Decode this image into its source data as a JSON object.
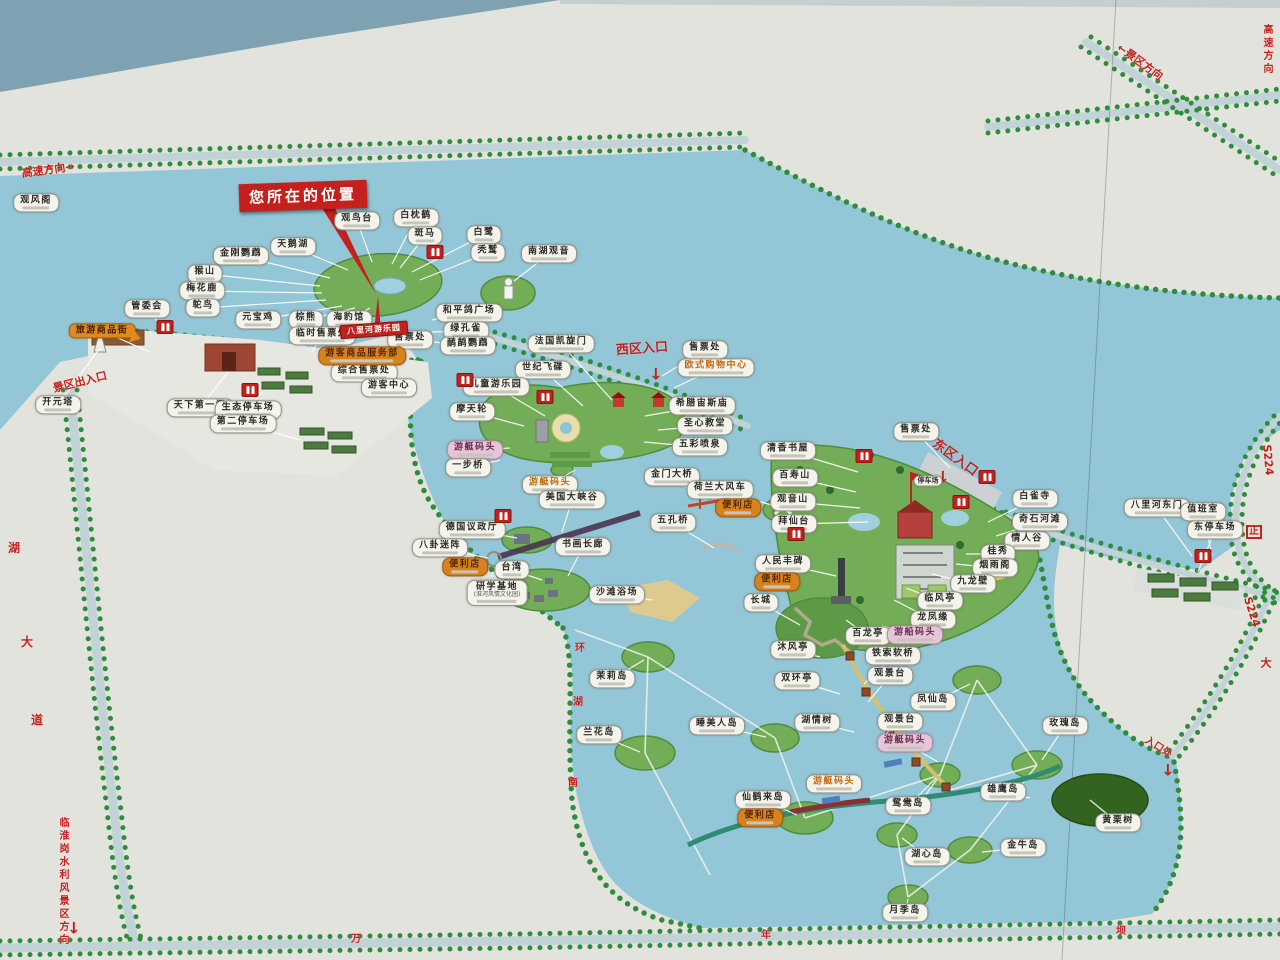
{
  "map": {
    "you_are_here": {
      "label": "您所在的位置",
      "x": 303,
      "y": 196
    },
    "colors": {
      "water": "#93c6d6",
      "board": "#e2e3dc",
      "tree_green": "#2f8c3c",
      "road": "#c2d3d8",
      "sign_red": "#c4201d",
      "label_bg": "#f4f3ec",
      "orange_label": "#d8821f",
      "pink_label": "#e5c6d8",
      "island_green": "#74ad57"
    },
    "road_signs": [
      {
        "t": "高速方向→",
        "x": 48,
        "y": 170,
        "rot": -8,
        "size": 11
      },
      {
        "t": "←景区方向",
        "x": 1140,
        "y": 62,
        "rot": 36,
        "size": 11
      },
      {
        "t": "高速方向",
        "x": 1266,
        "y": 50,
        "vert": true,
        "size": 10
      },
      {
        "t": "S224",
        "x": 1268,
        "y": 460,
        "rot": 85,
        "size": 11
      },
      {
        "t": "正",
        "x": 1254,
        "y": 532,
        "boxed": true,
        "size": 10
      },
      {
        "t": "S224",
        "x": 1252,
        "y": 612,
        "rot": 72,
        "size": 11
      },
      {
        "t": "入口处",
        "x": 1158,
        "y": 748,
        "rot": 32,
        "size": 10
      },
      {
        "t": "西区入口",
        "x": 642,
        "y": 349,
        "rot": -4,
        "size": 13
      },
      {
        "t": "东区入口",
        "x": 955,
        "y": 458,
        "rot": 36,
        "size": 13
      },
      {
        "t": "景区出入口",
        "x": 80,
        "y": 382,
        "rot": -14,
        "size": 11
      },
      {
        "t": "临淮岗水利风景区方向",
        "x": 62,
        "y": 882,
        "vert": true,
        "size": 10
      },
      {
        "t": "湖",
        "x": 14,
        "y": 548,
        "size": 12
      },
      {
        "t": "大",
        "x": 27,
        "y": 642,
        "size": 12
      },
      {
        "t": "道",
        "x": 37,
        "y": 720,
        "size": 12
      },
      {
        "t": "环",
        "x": 580,
        "y": 649,
        "size": 10
      },
      {
        "t": "湖",
        "x": 578,
        "y": 703,
        "size": 10
      },
      {
        "t": "南",
        "x": 573,
        "y": 784,
        "size": 10
      },
      {
        "t": "万",
        "x": 356,
        "y": 940,
        "size": 10
      },
      {
        "t": "年",
        "x": 766,
        "y": 936,
        "size": 10
      },
      {
        "t": "坝",
        "x": 1121,
        "y": 932,
        "size": 10
      },
      {
        "t": "大",
        "x": 1266,
        "y": 663,
        "size": 11
      }
    ],
    "arrows": [
      {
        "x": 656,
        "y": 374
      },
      {
        "x": 943,
        "y": 477
      },
      {
        "x": 1168,
        "y": 770
      },
      {
        "x": 74,
        "y": 928
      }
    ],
    "toilets": [
      {
        "x": 435,
        "y": 252
      },
      {
        "x": 465,
        "y": 380
      },
      {
        "x": 545,
        "y": 397
      },
      {
        "x": 864,
        "y": 456
      },
      {
        "x": 987,
        "y": 477
      },
      {
        "x": 961,
        "y": 502
      },
      {
        "x": 1203,
        "y": 556
      },
      {
        "x": 165,
        "y": 327
      },
      {
        "x": 250,
        "y": 390
      },
      {
        "x": 503,
        "y": 516
      },
      {
        "x": 796,
        "y": 534
      }
    ],
    "poi_labels": [
      {
        "t": "观风阁",
        "x": 36,
        "y": 203
      },
      {
        "t": "观鸟台",
        "x": 357,
        "y": 221,
        "lt": [
          372,
          262
        ]
      },
      {
        "t": "白枕鹤",
        "x": 416,
        "y": 218,
        "lt": [
          392,
          264
        ]
      },
      {
        "t": "斑马",
        "x": 425,
        "y": 236,
        "lt": [
          400,
          268
        ]
      },
      {
        "t": "白鹭",
        "x": 484,
        "y": 235,
        "lt": [
          412,
          272
        ]
      },
      {
        "t": "秃鹫",
        "x": 488,
        "y": 253,
        "lt": [
          420,
          280
        ]
      },
      {
        "t": "南湖观音",
        "x": 549,
        "y": 254,
        "lt": [
          514,
          281
        ]
      },
      {
        "t": "天鹅湖",
        "x": 293,
        "y": 247,
        "lt": [
          348,
          270
        ]
      },
      {
        "t": "金刚鹦鹉",
        "x": 241,
        "y": 256,
        "lt": [
          330,
          278
        ]
      },
      {
        "t": "猴山",
        "x": 205,
        "y": 274,
        "lt": [
          320,
          286
        ]
      },
      {
        "t": "梅花鹿",
        "x": 202,
        "y": 291,
        "lt": [
          322,
          293
        ]
      },
      {
        "t": "鸵鸟",
        "x": 203,
        "y": 308,
        "lt": [
          326,
          300
        ]
      },
      {
        "t": "管委会",
        "x": 147,
        "y": 309,
        "lt": [
          170,
          336
        ]
      },
      {
        "t": "元宝鸡",
        "x": 258,
        "y": 320,
        "lt": [
          342,
          306
        ]
      },
      {
        "t": "棕熊",
        "x": 306,
        "y": 320,
        "lt": [
          355,
          308
        ]
      },
      {
        "t": "海豹馆",
        "x": 349,
        "y": 320,
        "lt": [
          370,
          308
        ]
      },
      {
        "t": "和平鸽广场",
        "x": 469,
        "y": 313,
        "lt": [
          432,
          320
        ]
      },
      {
        "t": "绿孔雀",
        "x": 466,
        "y": 331,
        "lt": [
          432,
          332
        ]
      },
      {
        "t": "鸸鹋鹦鹉",
        "x": 468,
        "y": 346,
        "lt": [
          434,
          342
        ]
      },
      {
        "t": "售票处",
        "x": 410,
        "y": 340,
        "lt": [
          396,
          352
        ]
      },
      {
        "t": "临时售票处",
        "x": 322,
        "y": 336,
        "lt": [
          312,
          352
        ]
      },
      {
        "t": "综合售票处",
        "x": 364,
        "y": 373
      },
      {
        "t": "游客中心",
        "x": 389,
        "y": 388
      },
      {
        "t": "旅游商品街",
        "x": 102,
        "y": 331,
        "s": "balloon",
        "lt": [
          150,
          352
        ]
      },
      {
        "t": "游客商品服务部",
        "x": 362,
        "y": 356,
        "s": "orange"
      },
      {
        "t": "天下第一门",
        "x": 200,
        "y": 408,
        "lt": [
          228,
          372
        ]
      },
      {
        "t": "生态停车场",
        "x": 248,
        "y": 410,
        "lt": [
          262,
          392
        ]
      },
      {
        "t": "第二停车场",
        "x": 243,
        "y": 424,
        "lt": [
          300,
          440
        ]
      },
      {
        "t": "开元塔",
        "x": 58,
        "y": 405,
        "lt": [
          100,
          348
        ]
      },
      {
        "t": "八里河游乐园",
        "x": 374,
        "y": 330,
        "s": "banner"
      },
      {
        "t": "法国凯旋门",
        "x": 561,
        "y": 344,
        "lt": [
          612,
          400
        ]
      },
      {
        "t": "世纪飞碟",
        "x": 543,
        "y": 370,
        "lt": [
          583,
          406
        ]
      },
      {
        "t": "儿童游乐园",
        "x": 496,
        "y": 387,
        "lt": [
          545,
          416
        ]
      },
      {
        "t": "摩天轮",
        "x": 472,
        "y": 412,
        "lt": [
          524,
          426
        ]
      },
      {
        "t": "售票处",
        "x": 705,
        "y": 350,
        "lt": [
          662,
          376
        ]
      },
      {
        "t": "欧式购物中心",
        "x": 716,
        "y": 368,
        "s": "otext",
        "lt": [
          674,
          388
        ]
      },
      {
        "t": "希腊宙斯庙",
        "x": 702,
        "y": 406,
        "lt": [
          645,
          416
        ]
      },
      {
        "t": "圣心教堂",
        "x": 705,
        "y": 426,
        "lt": [
          658,
          430
        ]
      },
      {
        "t": "五彩喷泉",
        "x": 700,
        "y": 447,
        "lt": [
          644,
          442
        ]
      },
      {
        "t": "游艇码头",
        "x": 475,
        "y": 450,
        "s": "pink",
        "lt": [
          510,
          448
        ]
      },
      {
        "t": "一步桥",
        "x": 468,
        "y": 468,
        "lt": [
          500,
          460
        ]
      },
      {
        "t": "游艇码头",
        "x": 550,
        "y": 485,
        "s": "otext",
        "lt": [
          575,
          470
        ]
      },
      {
        "t": "美国大峡谷",
        "x": 572,
        "y": 500,
        "lt": [
          562,
          532
        ]
      },
      {
        "t": "金门大桥",
        "x": 672,
        "y": 477,
        "lt": [
          706,
          500
        ]
      },
      {
        "t": "荷兰大风车",
        "x": 720,
        "y": 490,
        "lt": [
          775,
          506
        ]
      },
      {
        "t": "便利店",
        "x": 738,
        "y": 508,
        "s": "orange"
      },
      {
        "t": "五孔桥",
        "x": 673,
        "y": 523,
        "lt": [
          714,
          548
        ]
      },
      {
        "t": "德国议政厅",
        "x": 472,
        "y": 530,
        "lt": [
          517,
          538
        ]
      },
      {
        "t": "八卦迷阵",
        "x": 440,
        "y": 548,
        "lt": [
          488,
          558
        ]
      },
      {
        "t": "便利店",
        "x": 465,
        "y": 567,
        "s": "orange"
      },
      {
        "t": "台湾",
        "x": 512,
        "y": 570,
        "lt": [
          542,
          580
        ]
      },
      {
        "t": "书画长廊",
        "x": 583,
        "y": 547,
        "lt": [
          568,
          576
        ]
      },
      {
        "t": "研学基地",
        "t2": "(淮河风情文化园)",
        "x": 497,
        "y": 593
      },
      {
        "t": "沙滩浴场",
        "x": 617,
        "y": 595,
        "lt": [
          652,
          600
        ]
      },
      {
        "t": "售票处",
        "x": 916,
        "y": 432,
        "lt": [
          950,
          468
        ]
      },
      {
        "t": "停车场",
        "x": 928,
        "y": 481,
        "s": "sm"
      },
      {
        "t": "清香书屋",
        "x": 788,
        "y": 451,
        "lt": [
          858,
          472
        ]
      },
      {
        "t": "百寿山",
        "x": 795,
        "y": 478,
        "lt": [
          856,
          492
        ]
      },
      {
        "t": "观音山",
        "x": 793,
        "y": 502,
        "lt": [
          860,
          508
        ]
      },
      {
        "t": "拜仙台",
        "x": 794,
        "y": 524,
        "lt": [
          868,
          522
        ]
      },
      {
        "t": "人民丰碑",
        "x": 783,
        "y": 564,
        "lt": [
          836,
          576
        ]
      },
      {
        "t": "白雀寺",
        "x": 1035,
        "y": 499,
        "lt": [
          988,
          522
        ]
      },
      {
        "t": "奇石河滩",
        "x": 1040,
        "y": 522,
        "lt": [
          996,
          536
        ]
      },
      {
        "t": "情人谷",
        "x": 1027,
        "y": 541,
        "lt": [
          992,
          548
        ]
      },
      {
        "t": "桂秀",
        "x": 998,
        "y": 554,
        "lt": [
          966,
          554
        ]
      },
      {
        "t": "烟雨阁",
        "x": 995,
        "y": 568,
        "lt": [
          956,
          564
        ]
      },
      {
        "t": "九龙壁",
        "x": 973,
        "y": 584,
        "lt": [
          932,
          574
        ]
      },
      {
        "t": "临风亭",
        "x": 940,
        "y": 601,
        "lt": [
          906,
          588
        ]
      },
      {
        "t": "龙凤缘",
        "x": 933,
        "y": 620,
        "lt": [
          894,
          600
        ]
      },
      {
        "t": "百龙亭",
        "x": 868,
        "y": 636,
        "lt": [
          846,
          620
        ]
      },
      {
        "t": "游船码头",
        "x": 915,
        "y": 635,
        "s": "pink",
        "lt": [
          882,
          626
        ]
      },
      {
        "t": "便利店",
        "x": 777,
        "y": 582,
        "s": "orange"
      },
      {
        "t": "长城",
        "x": 761,
        "y": 603,
        "lt": [
          800,
          625
        ]
      },
      {
        "t": "八里河东门",
        "x": 1157,
        "y": 508,
        "lt": [
          1192,
          556
        ]
      },
      {
        "t": "值班室",
        "x": 1203,
        "y": 512,
        "lt": [
          1212,
          556
        ]
      },
      {
        "t": "东停车场",
        "x": 1215,
        "y": 530,
        "lt": [
          1198,
          572
        ]
      },
      {
        "t": "沐风亭",
        "x": 793,
        "y": 650,
        "lt": [
          820,
          657
        ]
      },
      {
        "t": "双环亭",
        "x": 797,
        "y": 681,
        "lt": [
          840,
          694
        ]
      },
      {
        "t": "铁索软桥",
        "x": 893,
        "y": 656,
        "lt": [
          864,
          684
        ]
      },
      {
        "t": "观景台",
        "x": 890,
        "y": 676,
        "lt": [
          868,
          702
        ]
      },
      {
        "t": "湖情树",
        "x": 817,
        "y": 723,
        "lt": [
          854,
          732
        ]
      },
      {
        "t": "观景台",
        "x": 900,
        "y": 722,
        "lt": [
          882,
          737
        ]
      },
      {
        "t": "游艇码头",
        "x": 905,
        "y": 743,
        "s": "pink",
        "lt": [
          938,
          762
        ]
      },
      {
        "t": "游艇码头",
        "x": 834,
        "y": 784,
        "s": "otext",
        "lt": [
          860,
          792
        ]
      },
      {
        "t": "凤仙岛",
        "x": 933,
        "y": 702,
        "lt": [
          970,
          684
        ]
      },
      {
        "t": "玫瑰岛",
        "x": 1065,
        "y": 726,
        "lt": [
          1042,
          760
        ]
      },
      {
        "t": "茉莉岛",
        "x": 612,
        "y": 679,
        "lt": [
          644,
          660
        ]
      },
      {
        "t": "兰花岛",
        "x": 599,
        "y": 735,
        "lt": [
          640,
          752
        ]
      },
      {
        "t": "睡美人岛",
        "x": 717,
        "y": 726,
        "lt": [
          766,
          737
        ]
      },
      {
        "t": "仙鹤来岛",
        "x": 763,
        "y": 800,
        "lt": [
          797,
          815
        ]
      },
      {
        "t": "便利店",
        "x": 760,
        "y": 818,
        "s": "orange"
      },
      {
        "t": "鸳鸯岛",
        "x": 908,
        "y": 806,
        "lt": [
          936,
          778
        ]
      },
      {
        "t": "雄鹰岛",
        "x": 1003,
        "y": 792,
        "lt": [
          1030,
          798
        ]
      },
      {
        "t": "金牛岛",
        "x": 1023,
        "y": 848,
        "lt": [
          982,
          852
        ]
      },
      {
        "t": "湖心岛",
        "x": 927,
        "y": 857,
        "lt": [
          902,
          838
        ]
      },
      {
        "t": "月季岛",
        "x": 905,
        "y": 913,
        "lt": [
          908,
          899
        ]
      },
      {
        "t": "黄栗树",
        "x": 1118,
        "y": 823,
        "lt": [
          1090,
          800
        ]
      }
    ]
  }
}
